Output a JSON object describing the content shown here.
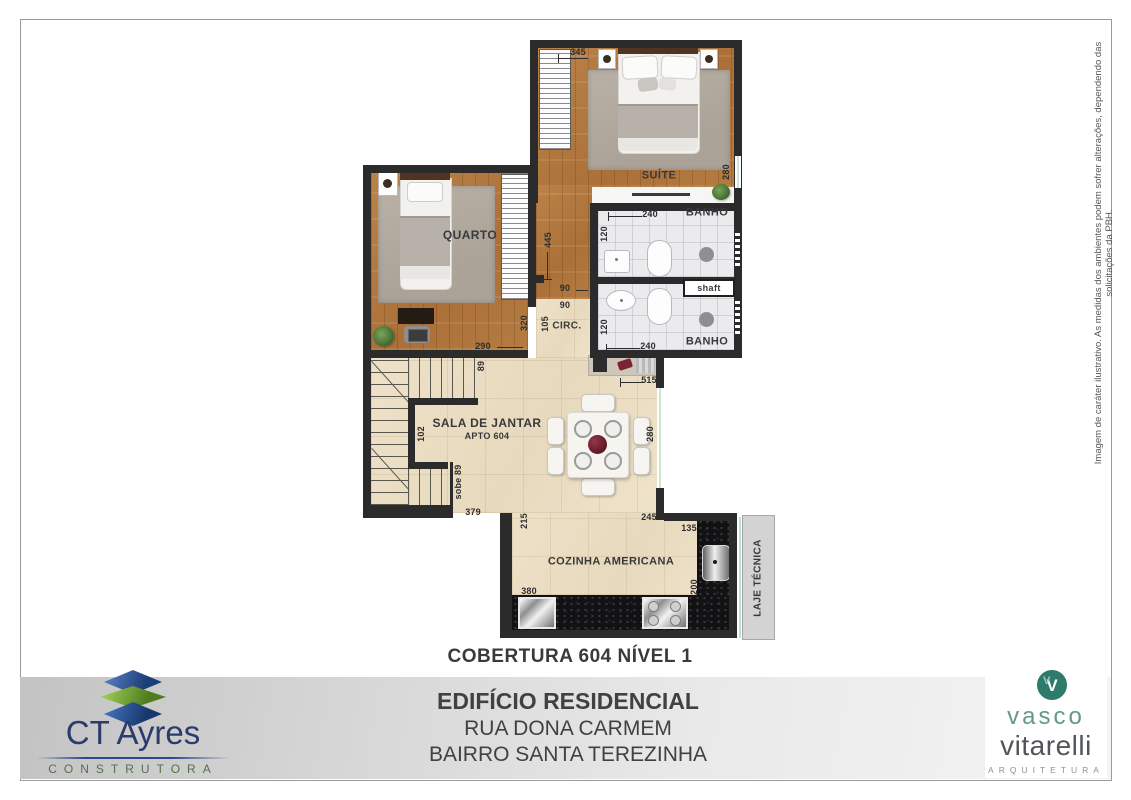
{
  "page": {
    "plan_title": "COBERTURA 604 NÍVEL 1",
    "building_line1": "EDIFÍCIO RESIDENCIAL",
    "building_line2": "RUA DONA CARMEM",
    "building_line3": "BAIRRO SANTA TEREZINHA",
    "disclaimer": "Imagem de caráter ilustrativo. As medidas dos ambientes podem sofrer alterações, dependendo das solicitações da PBH."
  },
  "logos": {
    "ct_ayres": {
      "name": "CT Ayres",
      "tagline": "CONSTRUTORA"
    },
    "vasco": {
      "monogram": "V",
      "monogram2": "V",
      "line1": "vasco",
      "line2": "vitarelli",
      "tagline": "ARQUITETURA"
    }
  },
  "colors": {
    "wall": "#2b2b2b",
    "wood": "#b57c42",
    "cream_tile": "#ebdfc5",
    "bath_tile": "#ebebee",
    "counter": "#121214",
    "rug": "#b3aa9f",
    "band_gray": "#c9c9c9",
    "ct_blue": "#2a3b6e",
    "ct_green": "#6fa32e",
    "vasco_teal": "#2e7a6b"
  },
  "plan": {
    "rooms": [
      {
        "t": "SUÍTE",
        "x": 659,
        "y": 176,
        "s": 11
      },
      {
        "t": "QUARTO",
        "x": 470,
        "y": 236,
        "s": 12
      },
      {
        "t": "BANHO",
        "x": 707,
        "y": 213,
        "s": 11
      },
      {
        "t": "BANHO",
        "x": 707,
        "y": 342,
        "s": 11
      },
      {
        "t": "CIRC.",
        "x": 567,
        "y": 326,
        "s": 10
      },
      {
        "t": "SALA DE JANTAR",
        "sub": "APTO 604",
        "x": 487,
        "y": 429,
        "s": 12
      },
      {
        "t": "COZINHA AMERICANA",
        "x": 611,
        "y": 562,
        "s": 11
      },
      {
        "t": "LAJE TÉCNICA",
        "x": 758,
        "y": 578,
        "s": 10,
        "r": 1
      },
      {
        "t": "shaft",
        "x": 709,
        "y": 288,
        "s": 9
      }
    ],
    "dimensions": [
      {
        "v": "345",
        "x": 578,
        "y": 52
      },
      {
        "v": "280",
        "x": 726,
        "y": 172,
        "r": 1
      },
      {
        "v": "240",
        "x": 650,
        "y": 214
      },
      {
        "v": "120",
        "x": 604,
        "y": 234,
        "r": 1
      },
      {
        "v": "120",
        "x": 604,
        "y": 327,
        "r": 1
      },
      {
        "v": "240",
        "x": 648,
        "y": 346
      },
      {
        "v": "445",
        "x": 548,
        "y": 240,
        "r": 1
      },
      {
        "v": "90",
        "x": 565,
        "y": 288
      },
      {
        "v": "90",
        "x": 565,
        "y": 305
      },
      {
        "v": "105",
        "x": 545,
        "y": 324,
        "r": 1
      },
      {
        "v": "320",
        "x": 524,
        "y": 323,
        "r": 1
      },
      {
        "v": "290",
        "x": 483,
        "y": 346
      },
      {
        "v": "89",
        "x": 481,
        "y": 366,
        "r": 1
      },
      {
        "v": "102",
        "x": 421,
        "y": 434,
        "r": 1
      },
      {
        "v": "sobe 89",
        "x": 458,
        "y": 482,
        "r": 1
      },
      {
        "v": "379",
        "x": 473,
        "y": 512
      },
      {
        "v": "215",
        "x": 524,
        "y": 521,
        "r": 1
      },
      {
        "v": "245",
        "x": 649,
        "y": 517
      },
      {
        "v": "280",
        "x": 650,
        "y": 434,
        "r": 1
      },
      {
        "v": "515",
        "x": 649,
        "y": 380
      },
      {
        "v": "135",
        "x": 689,
        "y": 528
      },
      {
        "v": "380",
        "x": 529,
        "y": 591
      },
      {
        "v": "200",
        "x": 694,
        "y": 587,
        "r": 1
      }
    ]
  }
}
